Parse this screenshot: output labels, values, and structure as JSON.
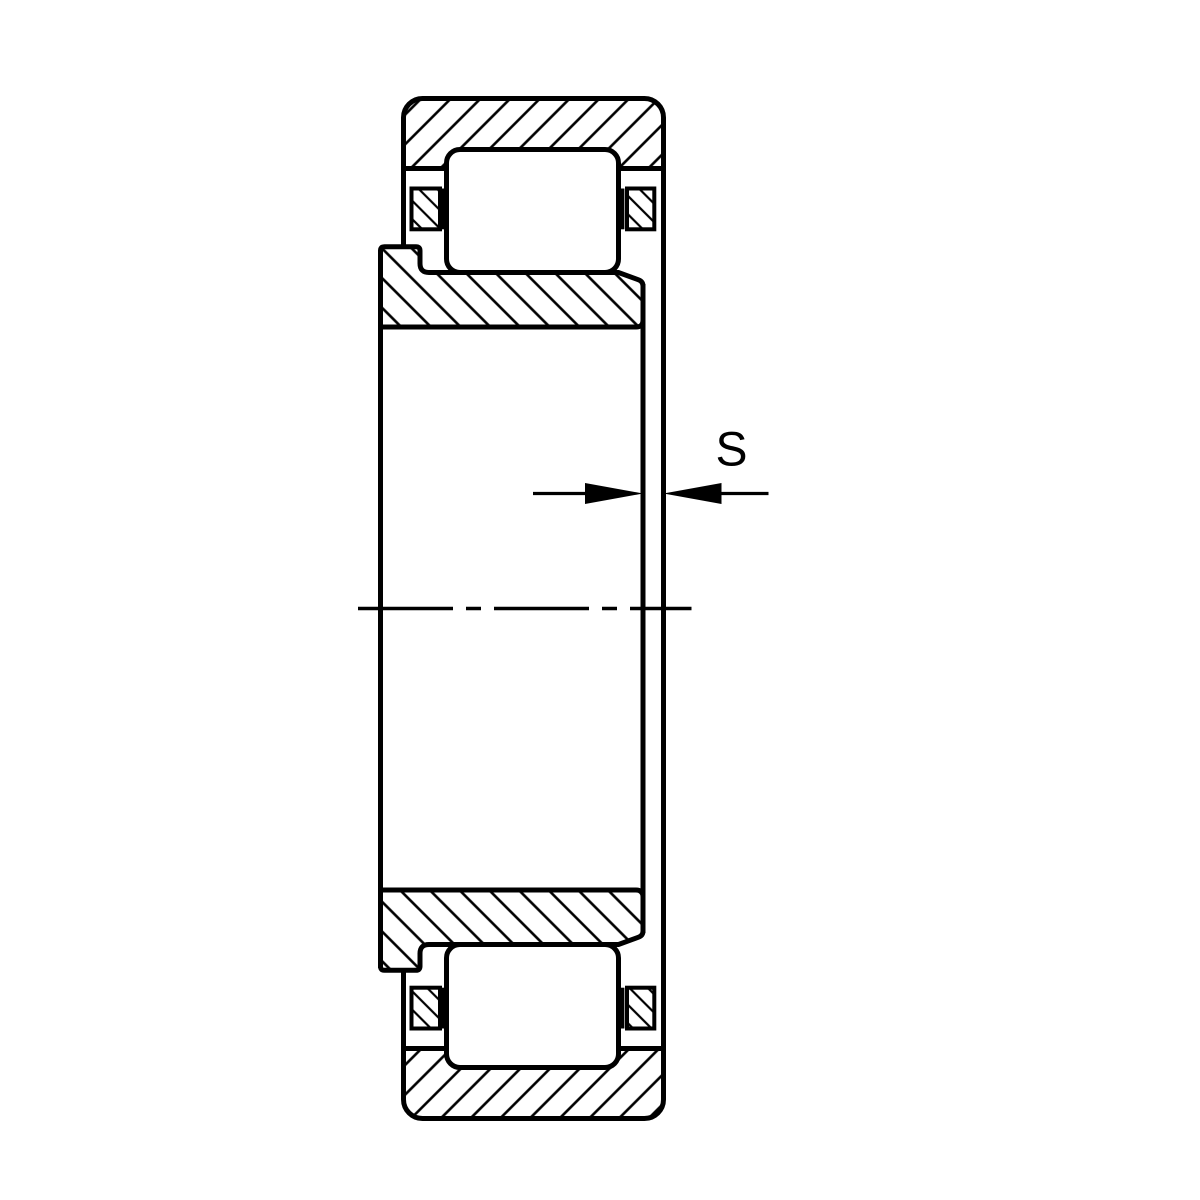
{
  "page": {
    "background_color": "#ffffff",
    "line_color": "#000000"
  },
  "drawing": {
    "type": "technical-section-drawing",
    "subject": "cylindrical-roller-bearing-cross-section",
    "dimension": {
      "label": "S"
    },
    "parts": [
      "outer-ring",
      "inner-ring",
      "roller",
      "cage",
      "axis-centerline",
      "axial-clearance-dimension"
    ]
  }
}
